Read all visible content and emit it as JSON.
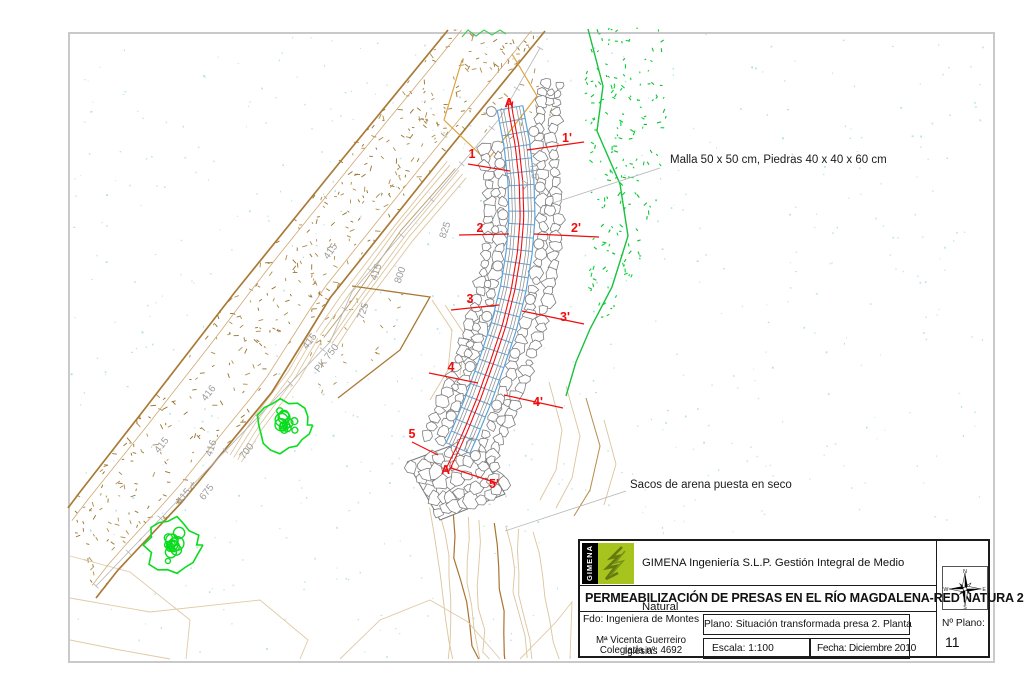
{
  "annotations": {
    "malla": "Malla 50 x 50 cm, Piedras 40 x 40 x 60 cm",
    "sacos": "Sacos de arena puesta en seco"
  },
  "section_markers": [
    {
      "label": "A",
      "x": 509,
      "y": 107
    },
    {
      "label": "A'",
      "x": 447,
      "y": 474
    },
    {
      "label": "1",
      "x": 472,
      "y": 158
    },
    {
      "label": "1'",
      "x": 567,
      "y": 142
    },
    {
      "label": "2",
      "x": 480,
      "y": 232
    },
    {
      "label": "2'",
      "x": 576,
      "y": 232
    },
    {
      "label": "3",
      "x": 470,
      "y": 303
    },
    {
      "label": "3'",
      "x": 565,
      "y": 321
    },
    {
      "label": "4",
      "x": 451,
      "y": 371
    },
    {
      "label": "4'",
      "x": 538,
      "y": 406
    },
    {
      "label": "5",
      "x": 412,
      "y": 438
    },
    {
      "label": "5'",
      "x": 494,
      "y": 488
    }
  ],
  "contour_labels": [
    {
      "text": "415",
      "x": 333,
      "y": 253,
      "rot": -55
    },
    {
      "text": "415",
      "x": 379,
      "y": 273,
      "rot": -72
    },
    {
      "text": "825",
      "x": 448,
      "y": 231,
      "rot": -72
    },
    {
      "text": "800",
      "x": 403,
      "y": 276,
      "rot": -72
    },
    {
      "text": "725",
      "x": 366,
      "y": 312,
      "rot": -72
    },
    {
      "text": "415",
      "x": 312,
      "y": 343,
      "rot": -52
    },
    {
      "text": "PK 750",
      "x": 329,
      "y": 360,
      "rot": -52
    },
    {
      "text": "416",
      "x": 211,
      "y": 395,
      "rot": -52
    },
    {
      "text": "415",
      "x": 164,
      "y": 447,
      "rot": -52
    },
    {
      "text": "416",
      "x": 214,
      "y": 449,
      "rot": -72
    },
    {
      "text": "675",
      "x": 209,
      "y": 494,
      "rot": -52
    },
    {
      "text": "415",
      "x": 186,
      "y": 498,
      "rot": -52
    },
    {
      "text": "700",
      "x": 249,
      "y": 453,
      "rot": -52
    },
    {
      "text": "415",
      "x": 531,
      "y": 171,
      "rot": 82
    }
  ],
  "title_block": {
    "logo_text": "GIMENA",
    "company": "GIMENA Ingeniería S.L.P. Gestión Integral de Medio Natural",
    "project": "PERMEABILIZACIÓN DE PRESAS EN EL RÍO MAGDALENA-RED NATURA 2000",
    "fdo": "Fdo: Ingeniera de Montes",
    "engineer_line1": "Mª Vicenta Guerreiro Iglesias",
    "engineer_line2": "Colegiada nº: 4692",
    "plano": "Plano: Situación transformada presa 2. Planta",
    "escala": "Escala: 1:100",
    "fecha": "Fecha: Diciembre 2010",
    "num_label": "Nº Plano:",
    "num_value": "11"
  },
  "compass": {
    "north": "N",
    "south": "S",
    "east": "E",
    "west": "W"
  },
  "colors": {
    "section_red": "#f20c0c",
    "mesh_blue": "#5fa3d8",
    "vegetation_green": "#17c23c",
    "tree_green": "#0bdc1e",
    "sand_tan": "#a97a35",
    "stipple_tan": "#b08c48",
    "contour_light": "#dcc49c",
    "contour_dark": "#a9742f",
    "speckle_cyan": "#a9dce6",
    "stone_grey": "#7d7d7d",
    "label_grey": "#9b9b9b",
    "track_grey": "#b4b4b4",
    "orange": "#dfa23c",
    "logo_green": "#a6c41d"
  }
}
